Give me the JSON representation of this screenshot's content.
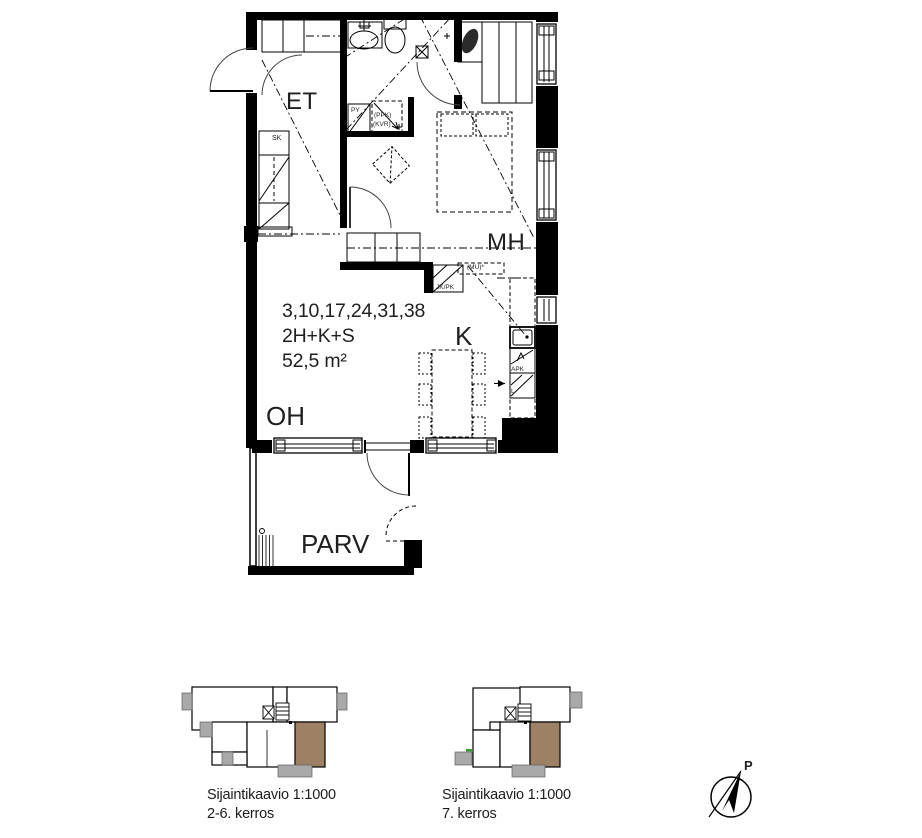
{
  "floor_plan": {
    "apartment_numbers": "3,10,17,24,31,38",
    "apartment_type": "2H+K+S",
    "area": "52,5 m²",
    "rooms": {
      "hall": "ET",
      "bedroom": "MH",
      "kitchen": "K",
      "living_room": "OH",
      "balcony": "PARV"
    },
    "fixtures": {
      "cleaning_closet": "SK",
      "laundry_spot": "PY",
      "washing_machine": "(PPK)",
      "drying_cabinet": "(KVR)",
      "fridge_freezer": "JK/PK",
      "microwave": "(MU)*",
      "dishwasher": "APK",
      "stove": "L"
    }
  },
  "location_diagrams": [
    {
      "title": "Sijaintikaavio 1:1000",
      "floors": "2-6. kerros"
    },
    {
      "title": "Sijaintikaavio 1:1000",
      "floors": "7. kerros"
    }
  ],
  "compass": {
    "north_label": "P"
  },
  "colors": {
    "line": "#000000",
    "apartment_highlight": "#9c8165",
    "balcony_gray": "#a9a9a9",
    "accent_green": "#33a02c"
  }
}
